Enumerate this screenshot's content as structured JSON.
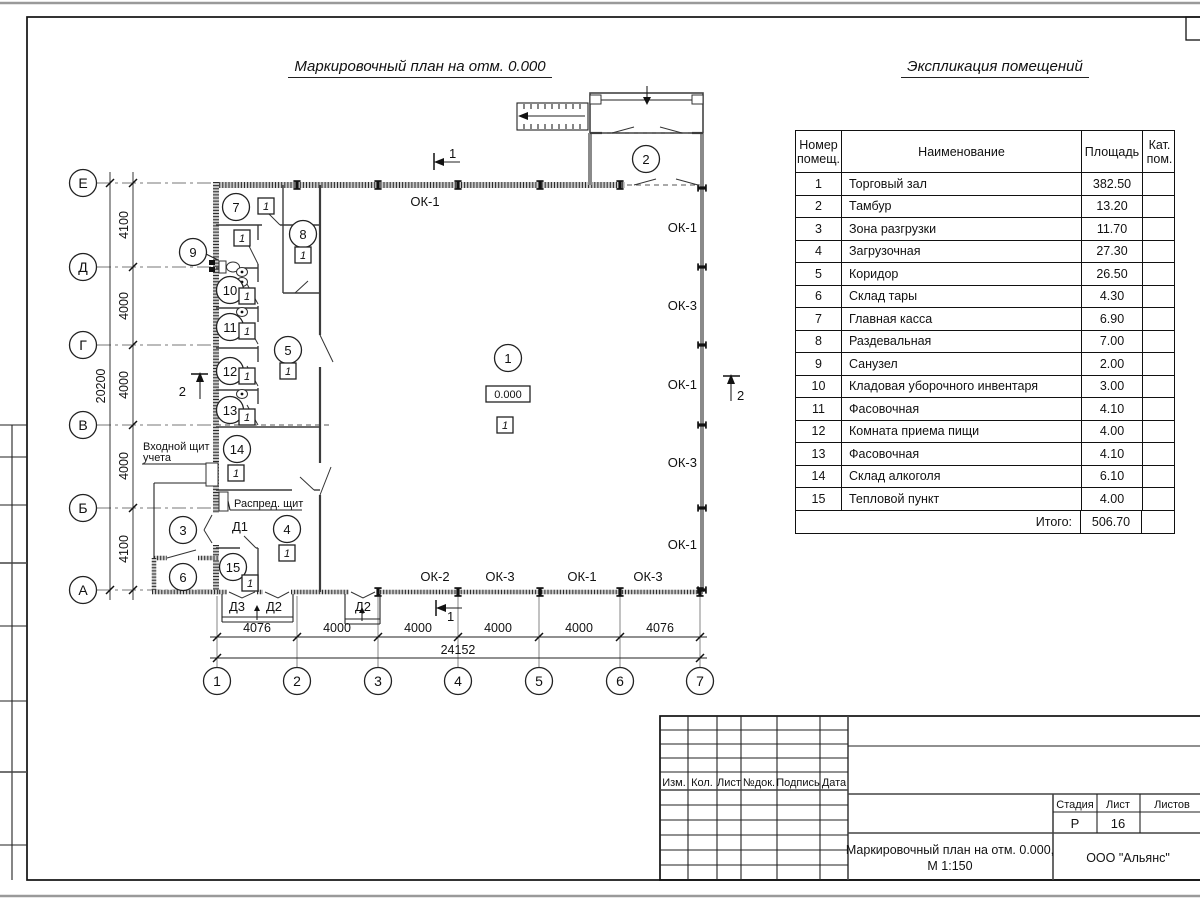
{
  "plan": {
    "title": "Маркировочный план на отм. 0.000",
    "elevation": "0.000",
    "door_mark": "1",
    "section1": "1",
    "section2": "2",
    "axis_rows": [
      "Е",
      "Д",
      "Г",
      "В",
      "Б",
      "А"
    ],
    "axis_cols": [
      "1",
      "2",
      "3",
      "4",
      "5",
      "6",
      "7"
    ],
    "dims_left": [
      "4100",
      "4000",
      "4000",
      "4000",
      "4100"
    ],
    "dim_left_total": "20200",
    "dims_bottom": [
      "4076",
      "4000",
      "4000",
      "4000",
      "4000",
      "4076"
    ],
    "dim_bottom_total": "24152",
    "rooms": [
      "1",
      "2",
      "3",
      "4",
      "5",
      "6",
      "7",
      "8",
      "9",
      "10",
      "11",
      "12",
      "13",
      "14",
      "15"
    ],
    "window_top": "ОК-1",
    "window_right": [
      "ОК-1",
      "ОК-3",
      "ОК-1",
      "ОК-3",
      "ОК-1"
    ],
    "window_bottom": [
      "ОК-2",
      "ОК-3",
      "ОК-1",
      "ОК-3"
    ],
    "doors": {
      "d1": "Д1",
      "d3": "Д3",
      "d2": "Д2",
      "d2b": "Д2"
    },
    "entry_panel_line1": "Входной щит",
    "entry_panel_line2": "учета",
    "dist_panel": "Распред. щит"
  },
  "explication": {
    "title": "Экспликация помещений",
    "headers": {
      "num_l1": "Номер",
      "num_l2": "помещ.",
      "name": "Наименование",
      "area": "Площадь",
      "cat_l1": "Кат.",
      "cat_l2": "пом."
    },
    "rows": [
      {
        "num": "1",
        "name": "Торговый зал",
        "area": "382.50"
      },
      {
        "num": "2",
        "name": "Тамбур",
        "area": "13.20"
      },
      {
        "num": "3",
        "name": "Зона разгрузки",
        "area": "11.70"
      },
      {
        "num": "4",
        "name": "Загрузочная",
        "area": "27.30"
      },
      {
        "num": "5",
        "name": "Коридор",
        "area": "26.50"
      },
      {
        "num": "6",
        "name": "Склад тары",
        "area": "4.30"
      },
      {
        "num": "7",
        "name": "Главная касса",
        "area": "6.90"
      },
      {
        "num": "8",
        "name": "Раздевальная",
        "area": "7.00"
      },
      {
        "num": "9",
        "name": "Санузел",
        "area": "2.00"
      },
      {
        "num": "10",
        "name": "Кладовая уборочного инвентаря",
        "area": "3.00"
      },
      {
        "num": "11",
        "name": "Фасовочная",
        "area": "4.10"
      },
      {
        "num": "12",
        "name": "Комната приема пищи",
        "area": "4.00"
      },
      {
        "num": "13",
        "name": "Фасовочная",
        "area": "4.10"
      },
      {
        "num": "14",
        "name": "Склад алкоголя",
        "area": "6.10"
      },
      {
        "num": "15",
        "name": "Тепловой пункт",
        "area": "4.00"
      }
    ],
    "total_label": "Итого:",
    "total_value": "506.70"
  },
  "title_block": {
    "rev_cols": [
      "Изм.",
      "Кол.",
      "Лист",
      "№док.",
      "Подпись",
      "Дата"
    ],
    "stage_label": "Стадия",
    "sheet_label": "Лист",
    "sheets_label": "Листов",
    "stage_value": "Р",
    "sheet_value": "16",
    "doc_title_line1": "Маркировочный план на отм. 0.000,",
    "doc_title_line2": "М 1:150",
    "company": "ООО \"Альянс\""
  }
}
